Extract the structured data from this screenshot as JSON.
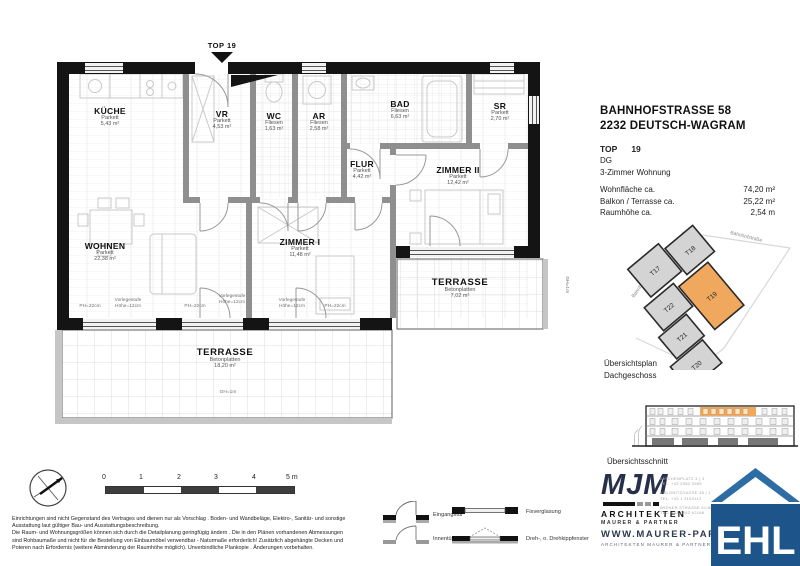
{
  "header": {
    "address_line1": "BAHNHOFSTRASSE 58",
    "address_line2": "2232 DEUTSCH-WAGRAM",
    "unit_label": "TOP",
    "unit_number": "19",
    "floor": "DG",
    "apartment_type": "3-Zimmer Wohnung"
  },
  "areas": {
    "rows": [
      {
        "label": "Wohnfläche ca.",
        "value": "74,20 m²"
      },
      {
        "label": "Balkon / Terrasse ca.",
        "value": "25,22 m²"
      },
      {
        "label": "Raumhöhe ca.",
        "value": "2,54 m"
      }
    ]
  },
  "plan": {
    "top_marker": "TOP 19",
    "rooms": [
      {
        "name": "KÜCHE",
        "finish": "Parkett",
        "area": "5,43 m²"
      },
      {
        "name": "VR",
        "finish": "Parkett",
        "area": "4,53 m²"
      },
      {
        "name": "WC",
        "finish": "Fliesen",
        "area": "1,63 m²"
      },
      {
        "name": "AR",
        "finish": "Fliesen",
        "area": "2,58 m²"
      },
      {
        "name": "BAD",
        "finish": "Fliesen",
        "area": "6,63 m²"
      },
      {
        "name": "SR",
        "finish": "Parkett",
        "area": "2,70 m²"
      },
      {
        "name": "FLUR",
        "finish": "Parkett",
        "area": "4,42 m²"
      },
      {
        "name": "ZIMMER II",
        "finish": "Parkett",
        "area": "12,42 m²"
      },
      {
        "name": "WOHNEN",
        "finish": "Parkett",
        "area": "22,38 m²"
      },
      {
        "name": "ZIMMER I",
        "finish": "Parkett",
        "area": "11,48 m²"
      },
      {
        "name": "TERRASSE",
        "finish": "Betonplatten",
        "area": "7,02 m²"
      },
      {
        "name": "TERRASSE",
        "finish": "Betonplatten",
        "area": "18,20 m²"
      }
    ],
    "annotations": {
      "ph": "PH=22cm",
      "step": "Vorlegestufe Höhe=12cm",
      "gh": "GH=1m"
    }
  },
  "site_plan": {
    "caption_line1": "Übersichtsplan",
    "caption_line2": "Dachgeschoss",
    "street_top": "Bahnhofstraße",
    "street_left": "Bahnhofstraße",
    "units": [
      "T17",
      "T18",
      "T22",
      "T21",
      "T19",
      "T20"
    ],
    "highlight_unit": "T19",
    "highlight_color": "#f0a85f"
  },
  "section": {
    "caption": "Übersichtsschnitt",
    "highlight_color": "#f0a85f"
  },
  "scale_bar": {
    "ticks": [
      "0",
      "1",
      "2",
      "3",
      "4"
    ],
    "end_label": "5 m"
  },
  "legend": {
    "items": [
      "Eingangstür",
      "Innentür",
      "Fixverglasung",
      "Dreh-, o. Drehkippfenster"
    ]
  },
  "disclaimer": {
    "lines": [
      "Einrichtungen sind nicht Gegenstand des Vertrages und dienen nur als Vorschlag . Boden- und Wandbeläge, Elektro-, Sanitär- und sonstige",
      "Ausstattung laut gültiger Bau- und Ausstattungsbeschreibung.",
      "Die Raum- und Wohnungsgrößen können sich durch die Detailplanung geringfügig ändern . Die in den Plänen vorhandenen Abmessungen",
      "sind Rohbaumaße und nicht für die Bestellung von Einbaumöbel verwendbar - Naturmaße erforderlich! Zusätzlich abgehängte Decken und",
      "Poteren nach Erfordernis (weitere Abminderung der Raumhöhe möglich). Unverbindliche Plankopie . Änderungen vorbehalten."
    ]
  },
  "mjm": {
    "logo_text": "MJM",
    "line1": "ARCHITEKTEN",
    "line2": "MAURER & PARTNER",
    "addresses": [
      {
        "street": "KIRCHENPLATZ 3 | 3",
        "tel": "TEL: +43 2982 3965"
      },
      {
        "street": "KOLONITZGASSE 35 | 1",
        "tel": "TEL: +43 1 3193112"
      },
      {
        "street": "WIENER STRASSE 61/66 | 2",
        "tel": "TEL: +43 2262 62168"
      }
    ],
    "website": "WWW.MAURER-PARTNER",
    "website_sub": "ARCHITEKTEN MAURER & PARTNER ZT G"
  },
  "ehl": {
    "text": "EHL",
    "color": "#1d558a"
  }
}
